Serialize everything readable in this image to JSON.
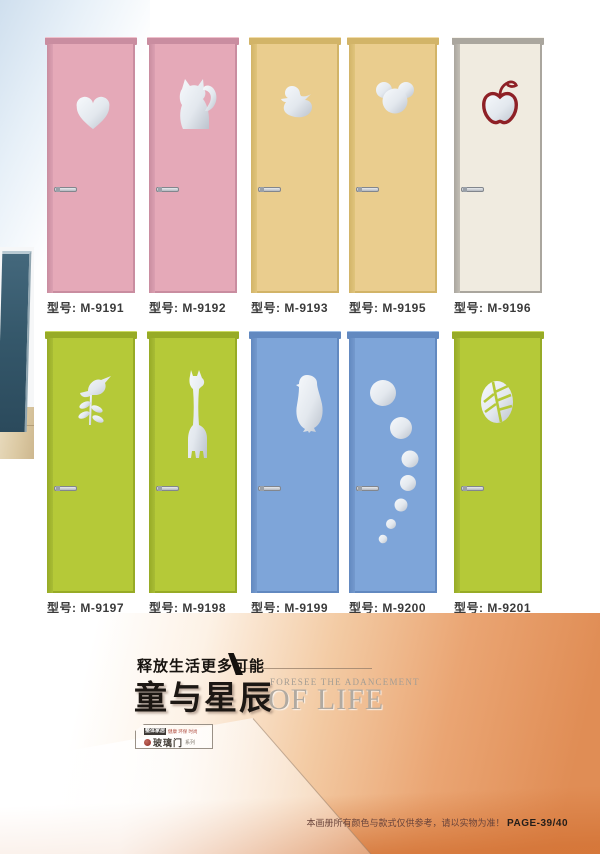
{
  "doors": [
    {
      "label": "型号: M-9191",
      "motif": "heart",
      "leaf": "#e5a9b8",
      "edge": "#c98da0",
      "cap_hi": "#f0c1cc"
    },
    {
      "label": "型号: M-9192",
      "motif": "cat",
      "leaf": "#e5a9b8",
      "edge": "#c98da0",
      "cap_hi": "#f0c1cc"
    },
    {
      "label": "型号: M-9193",
      "motif": "duck",
      "leaf": "#eacd8e",
      "edge": "#d2b468",
      "cap_hi": "#f3dda9"
    },
    {
      "label": "型号: M-9195",
      "motif": "mickey",
      "leaf": "#eacd8e",
      "edge": "#d2b468",
      "cap_hi": "#f3dda9"
    },
    {
      "label": "型号: M-9196",
      "motif": "apple",
      "leaf": "#f0ebe0",
      "edge": "#aaa69e",
      "cap_hi": "#f8f4ec"
    },
    {
      "label": "型号: M-9197",
      "motif": "bird-branch",
      "leaf": "#b5c938",
      "edge": "#97ab26",
      "cap_hi": "#cbda60"
    },
    {
      "label": "型号: M-9198",
      "motif": "giraffe",
      "leaf": "#b5c938",
      "edge": "#97ab26",
      "cap_hi": "#cbda60"
    },
    {
      "label": "型号: M-9199",
      "motif": "penguin",
      "leaf": "#7ea5d9",
      "edge": "#6289c0",
      "cap_hi": "#9dbde5"
    },
    {
      "label": "型号: M-9200",
      "motif": "bubbles",
      "leaf": "#7ea5d9",
      "edge": "#6289c0",
      "cap_hi": "#9dbde5"
    },
    {
      "label": "型号: M-9201",
      "motif": "leaf-oval",
      "leaf": "#b5c938",
      "edge": "#97ab26",
      "cap_hi": "#cbda60"
    }
  ],
  "banner": {
    "tagline": "释放生活更多可能",
    "title": "童与星辰",
    "subtitle_small": "FORESEE THE ADANCEMENT",
    "subtitle_large": "OF LIFE",
    "logo_box": {
      "chip": "整体家居",
      "red_text": "健康 环保 时尚",
      "brand": "玻璃门",
      "suffix": "系列"
    },
    "footer_note": "本画册所有颜色与款式仅供参考，请以实物为准！",
    "page_number": "PAGE-39/40"
  },
  "colors": {
    "cutout_silver_light": "#f6f9fc",
    "cutout_silver_dark": "#bcc3cd",
    "apple_outline": "#8e2026",
    "banner_orange": "#e08d55"
  }
}
